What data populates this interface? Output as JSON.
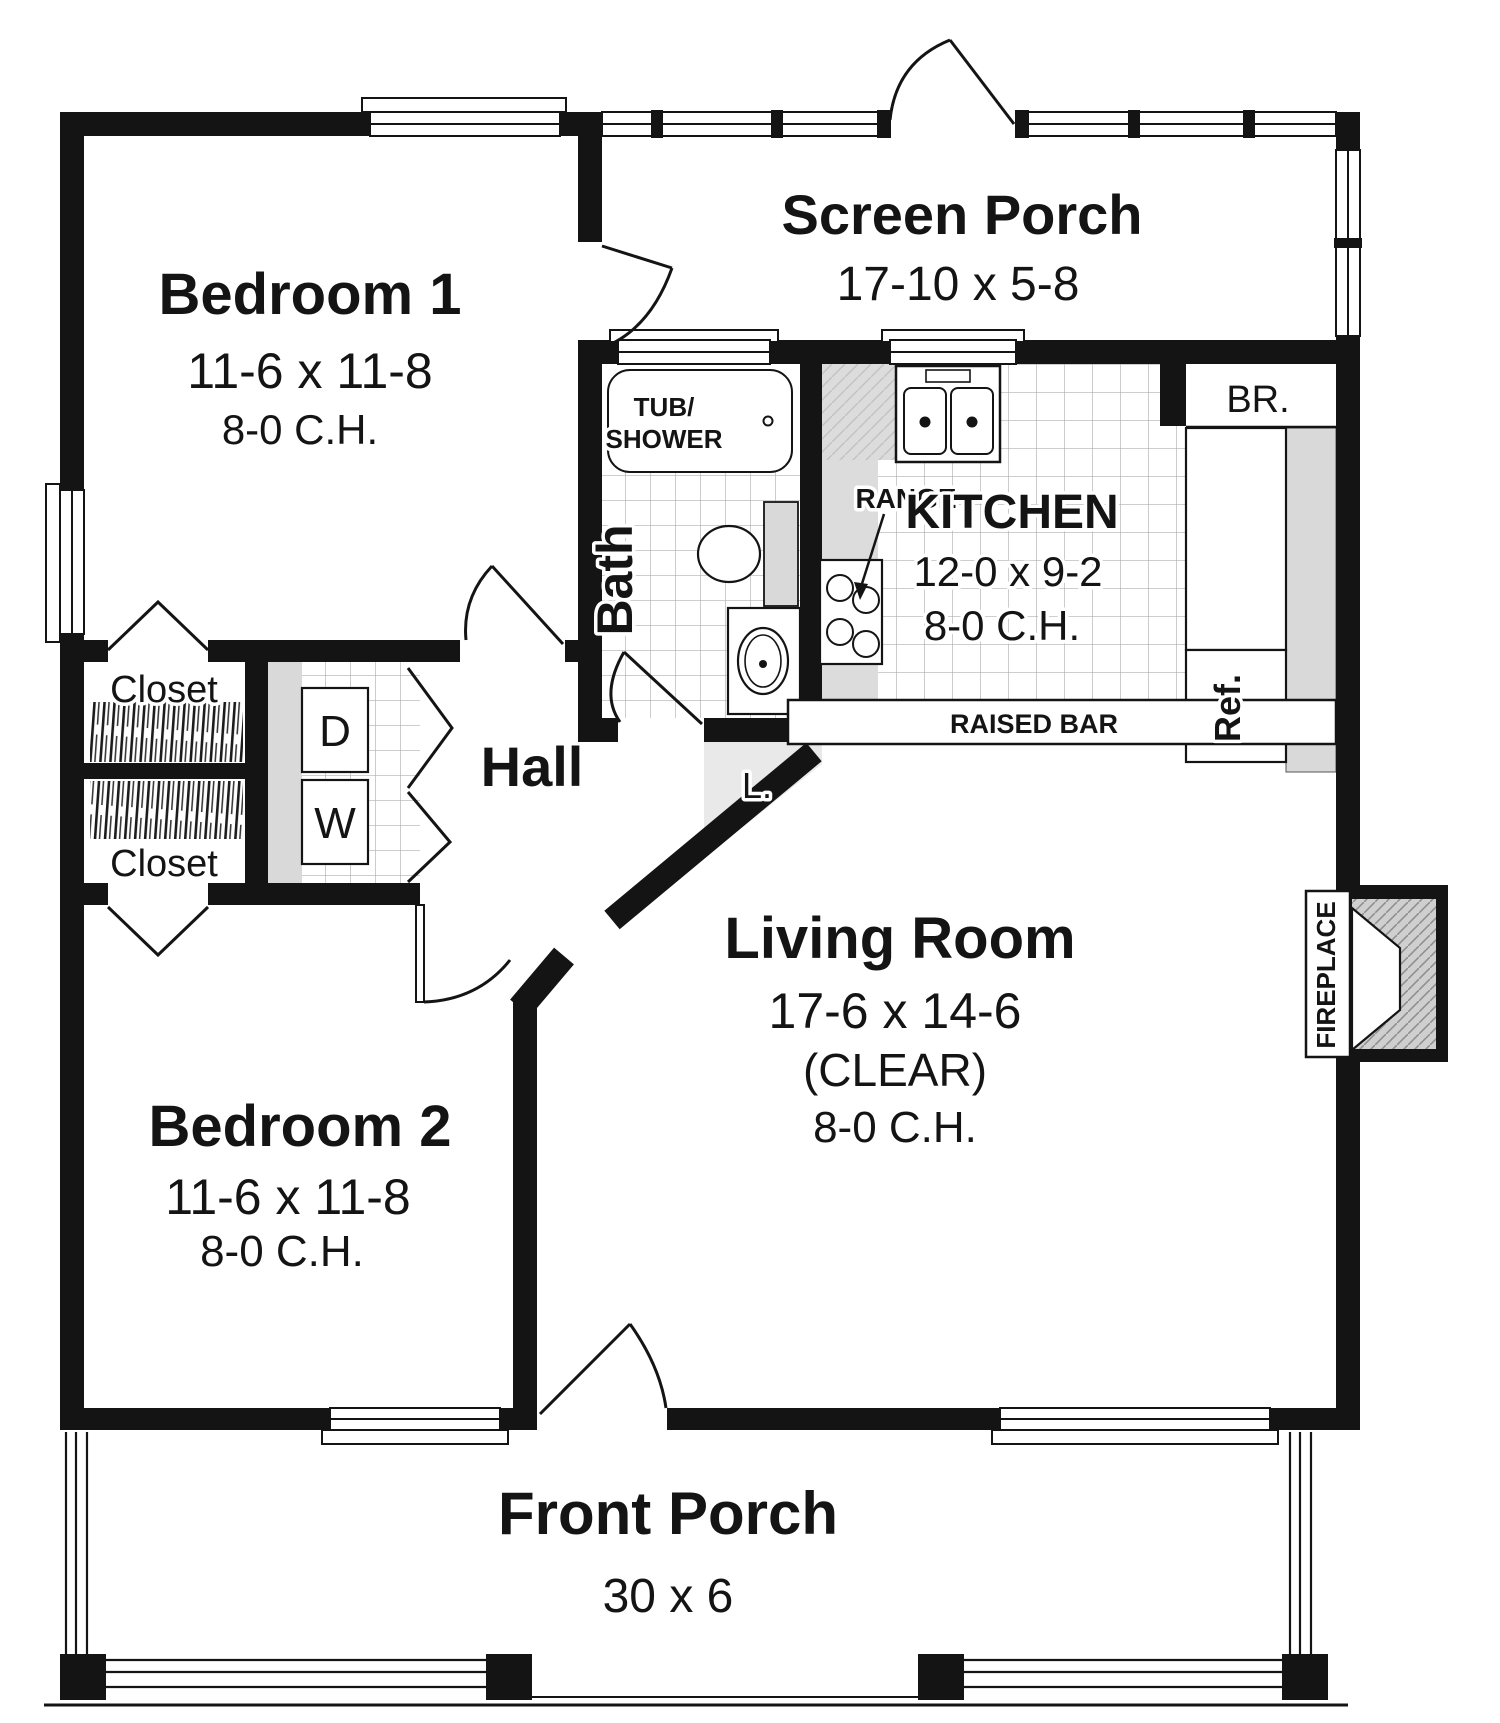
{
  "plan": {
    "rooms": {
      "bedroom1": {
        "name": "Bedroom 1",
        "dims": "11-6 x 11-8",
        "ceiling": "8-0 C.H."
      },
      "screen_porch": {
        "name": "Screen Porch",
        "dims": "17-10 x 5-8"
      },
      "kitchen": {
        "name": "KITCHEN",
        "dims": "12-0 x 9-2",
        "ceiling": "8-0 C.H."
      },
      "bath": {
        "name": "Bath"
      },
      "hall": {
        "name": "Hall"
      },
      "living": {
        "name": "Living Room",
        "dims": "17-6 x 14-6",
        "clear": "(CLEAR)",
        "ceiling": "8-0 C.H."
      },
      "bedroom2": {
        "name": "Bedroom 2",
        "dims": "11-6 x 11-8",
        "ceiling": "8-0 C.H."
      },
      "front_porch": {
        "name": "Front Porch",
        "dims": "30 x 6"
      },
      "closet_top": {
        "name": "Closet"
      },
      "closet_bottom": {
        "name": "Closet"
      }
    },
    "fixtures": {
      "tub_line1": "TUB/",
      "tub_line2": "SHOWER",
      "range": "RANGE",
      "raised_bar": "RAISED BAR",
      "broom": "BR.",
      "fridge": "Ref.",
      "linen": "L.",
      "fireplace": "FIREPLACE",
      "dryer": "D",
      "washer": "W"
    }
  },
  "colors": {
    "wall": "#141414",
    "counter_gray": "#dcdcdc",
    "appliance_gray": "#d9d9d9",
    "tile_line": "#b0b0b0"
  }
}
